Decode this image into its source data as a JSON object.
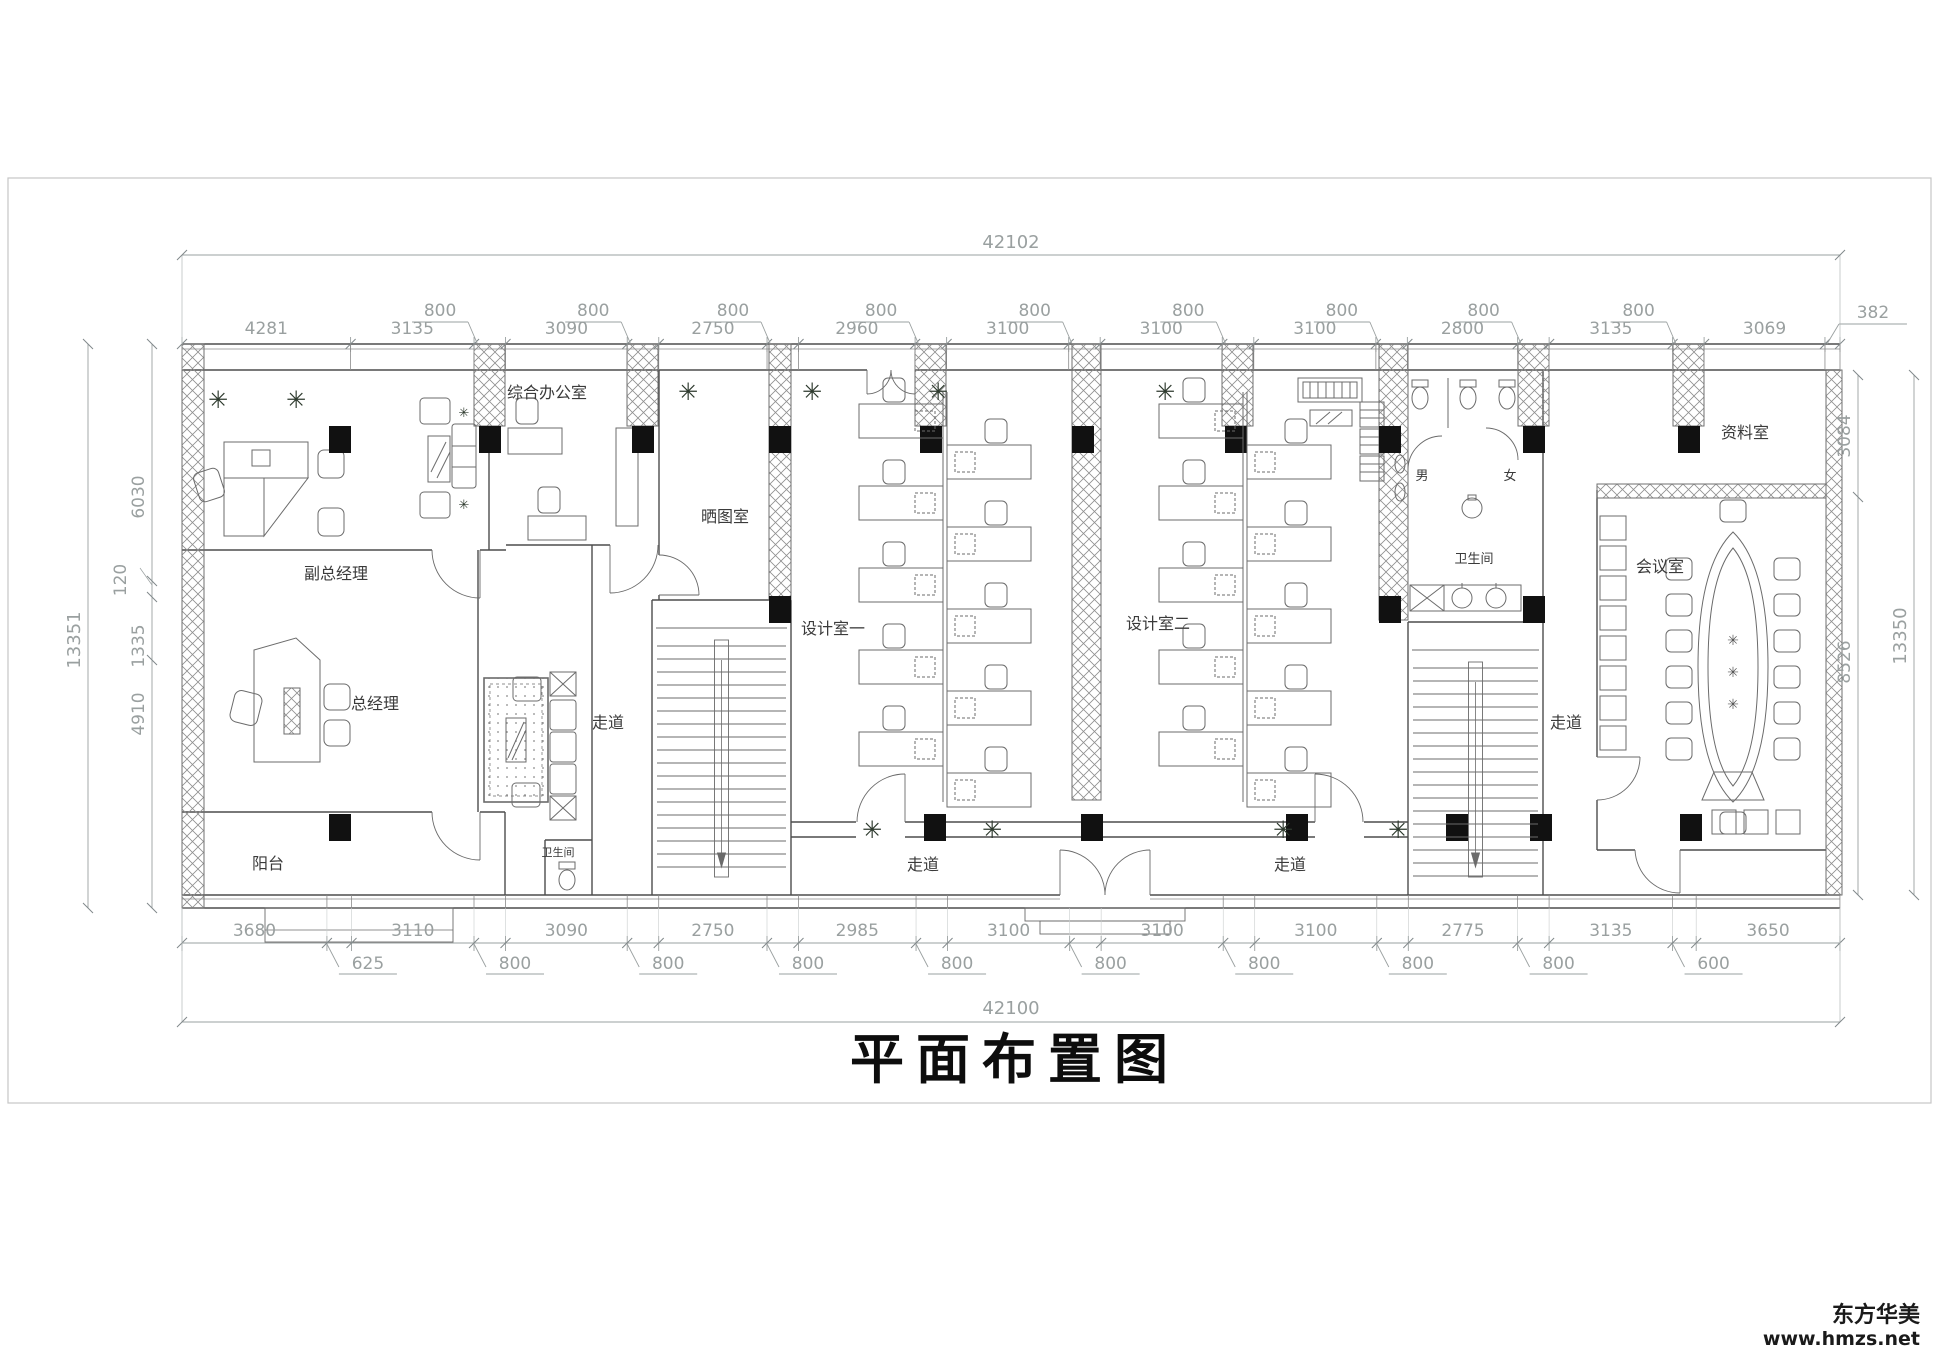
{
  "title": "平面布置图",
  "watermark": {
    "line1": "东方华美",
    "line2": "www.hmzs.net"
  },
  "totals": {
    "top": "42102",
    "bottom": "42100",
    "left": "13351",
    "right": "13350"
  },
  "dims": {
    "top_chain": [
      4281,
      3135,
      800,
      3090,
      800,
      2750,
      800,
      2960,
      800,
      3100,
      800,
      3100,
      800,
      3100,
      800,
      2800,
      800,
      3135,
      800,
      3069,
      382
    ],
    "bottom_chain": [
      3680,
      625,
      3110,
      800,
      3090,
      800,
      2750,
      800,
      2985,
      800,
      3100,
      800,
      3100,
      800,
      3100,
      800,
      2775,
      800,
      3135,
      600,
      3650
    ],
    "left_segments": [
      "6030",
      "120",
      "1335",
      "4910"
    ],
    "right_segments": [
      "3084",
      "8526"
    ]
  },
  "rooms": {
    "deputy_gm": "副总经理",
    "gm": "总经理",
    "general_office": "综合办公室",
    "blueprint": "晒图室",
    "design1": "设计室一",
    "design2": "设计室二",
    "archive": "资料室",
    "meeting": "会议室",
    "restroom": "卫生间",
    "restroom_small": "卫生间",
    "male": "男",
    "female": "女",
    "balcony": "阳台",
    "corridor": "走道"
  }
}
